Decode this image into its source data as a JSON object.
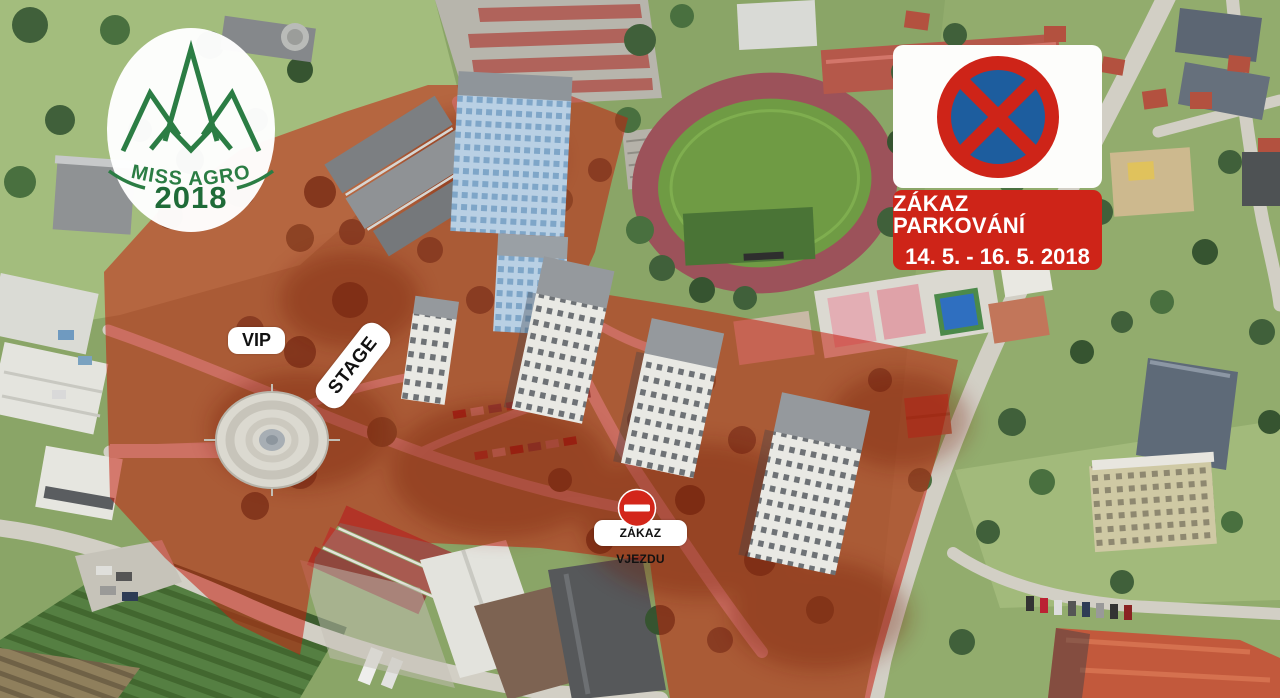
{
  "event_logo": {
    "title": "MISS AGRO",
    "year": "2018",
    "brand_green": "#2b7d44"
  },
  "no_parking_sign": {
    "icon": "no-stopping-sign-icon",
    "title": "ZÁKAZ PARKOVÁNÍ",
    "dates": "14. 5. - 16. 5. 2018",
    "panel_red": "#ce2418",
    "sign_blue": "#1d5d9e"
  },
  "map_annotations": {
    "vip": "VIP",
    "stage": "STAGE",
    "no_entry": "ZÁKAZ VJEZDU",
    "no_entry_icon": "no-entry-sign-icon",
    "restricted_zone_color": "#c41f0e"
  }
}
